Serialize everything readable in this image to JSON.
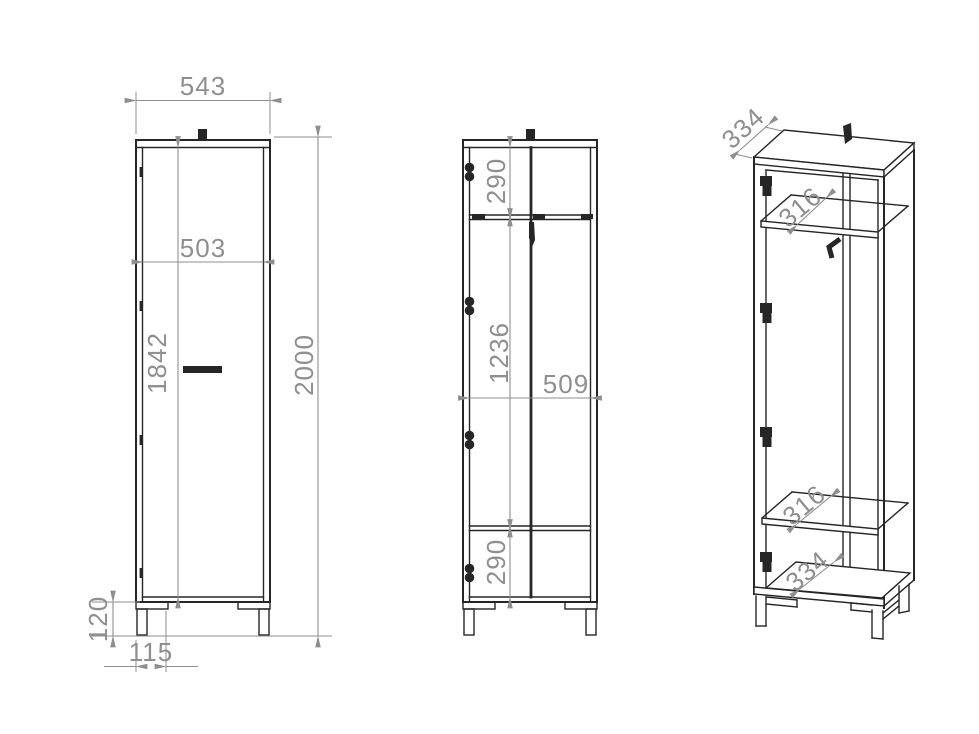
{
  "colors": {
    "line": "#262626",
    "dimension": "#8f8f8f",
    "background": "#ffffff"
  },
  "views": {
    "front": {
      "width": "543",
      "inner_width": "503",
      "inner_height": "1842",
      "total_height": "2000",
      "leg_height": "120",
      "leg_inset": "115"
    },
    "section": {
      "top_compartment": "290",
      "middle_compartment": "1236",
      "inner_width": "509",
      "bottom_compartment": "290"
    },
    "perspective": {
      "top_depth": "334",
      "upper_shelf_depth": "316",
      "lower_shelf_depth": "316",
      "bottom_depth": "334"
    }
  }
}
